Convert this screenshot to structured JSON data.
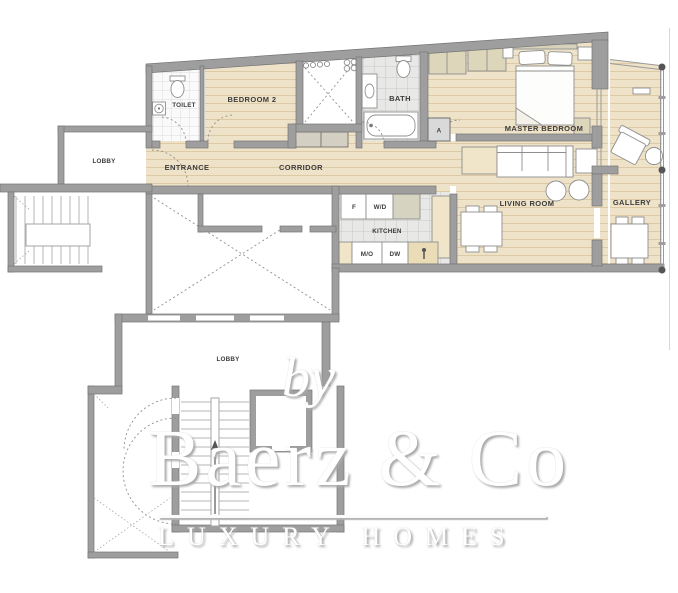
{
  "floor_plan": {
    "room_labels": {
      "toilet": "TOILET",
      "bedroom2": "BEDROOM 2",
      "entrance": "ENTRANCE",
      "corridor": "CORRIDOR",
      "bath": "BATH",
      "master_bedroom": "MASTER BEDROOM",
      "living_room": "LIVING ROOM",
      "gallery": "GALLERY",
      "kitchen": "KITCHEN",
      "lobby_upper": "LOBBY",
      "lobby_lower": "LOBBY",
      "shaft_a": "A"
    },
    "appliance_labels": {
      "fridge": "F",
      "washer_dryer": "W/D",
      "microwave_oven": "M/O",
      "dishwasher": "DW"
    },
    "colors": {
      "wall": "#9e9e9e",
      "wall_stroke": "#757575",
      "wood_floor": "#eee2c8",
      "wood_plank_line": "#dccaa6",
      "tile_floor": "#e8e8e6",
      "tile_line": "#c8c8c6",
      "closet_fill": "#ddd6bb",
      "counter_fill": "#f0e5c9",
      "label_text": "#3c3c3c",
      "glass_post": "#555555"
    }
  },
  "watermark": {
    "prefix": "by",
    "brand": "Baerz & Co",
    "tagline": "LUXURY HOMES"
  }
}
